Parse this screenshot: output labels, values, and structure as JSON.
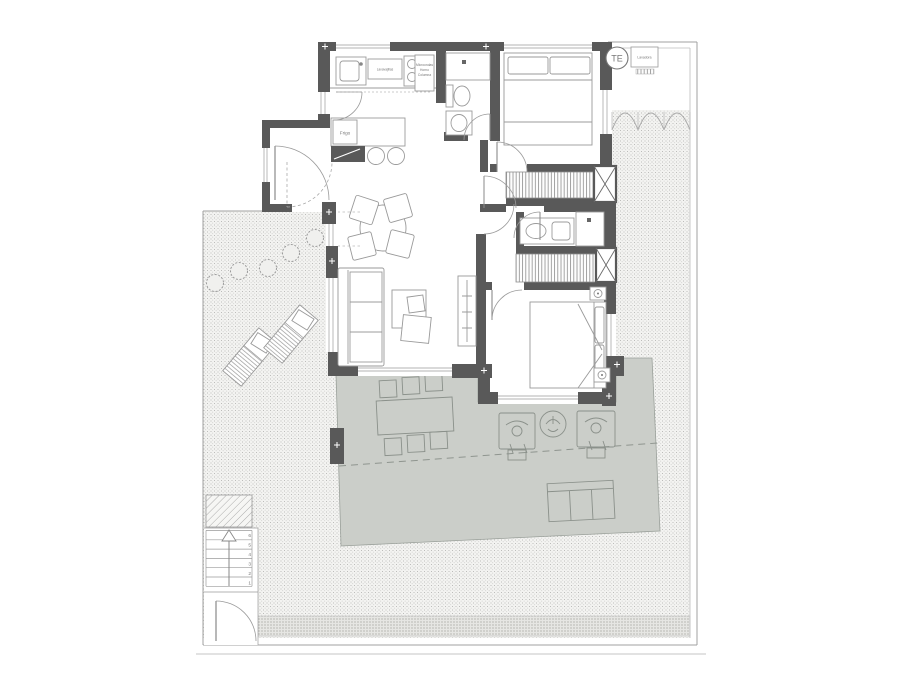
{
  "colors": {
    "background": "#ffffff",
    "wall": "#595959",
    "terrace": "#cbcec9",
    "line": "#9b9b9b",
    "garden_dot": "#b9b9b7"
  },
  "labels": {
    "utility_circle": "TE",
    "washer": "Lavadora",
    "fridge": "Frigo",
    "dishwasher": "Lavavajillas",
    "tall_unit_line1": "Microondas",
    "tall_unit_line2": "Horno",
    "tall_unit_line3": "Columna"
  },
  "stairs": {
    "step_numbers": [
      "1",
      "2",
      "3",
      "4",
      "5",
      "6"
    ]
  }
}
